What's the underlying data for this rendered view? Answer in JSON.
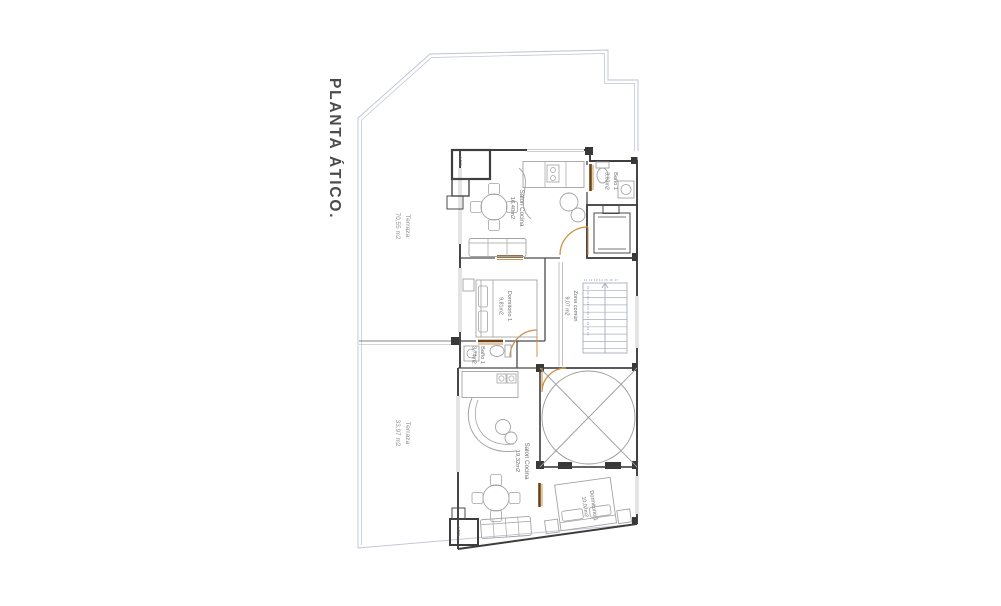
{
  "title": "PLANTA ÁTICO.",
  "rooms": {
    "terraza_upper": {
      "name": "Terraza",
      "area": "70,55 m2"
    },
    "terraza_lower": {
      "name": "Terraza",
      "area": "33,97 m2"
    },
    "salon_cocina_upper": {
      "name": "Salon Cocina",
      "area": "16,40m2"
    },
    "bano_top": {
      "name": "Baño 1",
      "area": "3,03m2"
    },
    "zona_comun": {
      "name": "Zona común",
      "area": "9,07 m2"
    },
    "dormitorio_upper": {
      "name": "Dormitorio 1",
      "area": "9,81m2"
    },
    "bano_mid": {
      "name": "Baño 1",
      "area": "3,74m2"
    },
    "salon_cocina_lower": {
      "name": "Salon Cocina",
      "area": "19,32m2"
    },
    "dormitorio_lower": {
      "name": "Dormitorio 1",
      "area": "10,02m2"
    }
  },
  "utility_labels": {
    "acs_upper": "ACS",
    "acs_lower": "ACS"
  },
  "stairs": {
    "flight_down_numbers": "01 02 03 04 05 06 07 08 09 10",
    "flight_up_numbers": "11 12 13 14 15 16 17"
  },
  "colors": {
    "wall": "#3d3d3d",
    "door_swing": "#cd9045",
    "door_leaf": "#6b4115",
    "site_boundary": "#bcc2d2",
    "furniture": "#a3a3a3",
    "title_text": "#4b4b4b",
    "background": "#ffffff"
  }
}
